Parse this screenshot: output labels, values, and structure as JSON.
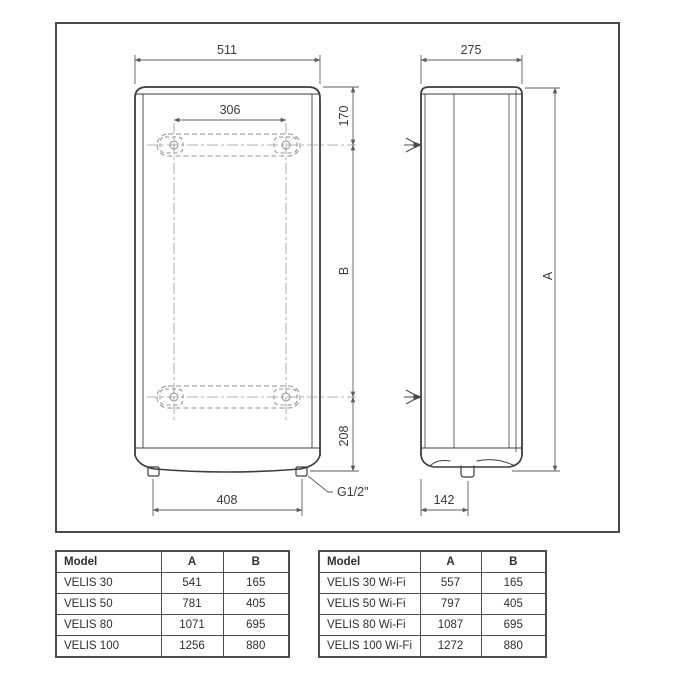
{
  "drawing": {
    "front_view": {
      "width_label": "511",
      "bracket_span_label": "306",
      "top_offset_label": "170",
      "height_label": "B",
      "bottom_offset_label": "208",
      "feet_span_label": "408",
      "connection_label": "G1/2\""
    },
    "side_view": {
      "depth_label": "275",
      "height_label": "A",
      "fitting_offset_label": "142"
    }
  },
  "tables": {
    "standard": {
      "headers": [
        "Model",
        "A",
        "B"
      ],
      "rows": [
        [
          "VELIS 30",
          "541",
          "165"
        ],
        [
          "VELIS 50",
          "781",
          "405"
        ],
        [
          "VELIS 80",
          "1071",
          "695"
        ],
        [
          "VELIS 100",
          "1256",
          "880"
        ]
      ]
    },
    "wifi": {
      "headers": [
        "Model",
        "A",
        "B"
      ],
      "rows": [
        [
          "VELIS 30 Wi-Fi",
          "557",
          "165"
        ],
        [
          "VELIS 50 Wi-Fi",
          "797",
          "405"
        ],
        [
          "VELIS 80 Wi-Fi",
          "1087",
          "695"
        ],
        [
          "VELIS 100 Wi-Fi",
          "1272",
          "880"
        ]
      ]
    }
  },
  "colors": {
    "object_line": "#3d3d3d",
    "dim_line": "#5c5c5c",
    "hidden_line": "#8f8f8f",
    "border": "#4a4a4a",
    "background": "#ffffff"
  }
}
